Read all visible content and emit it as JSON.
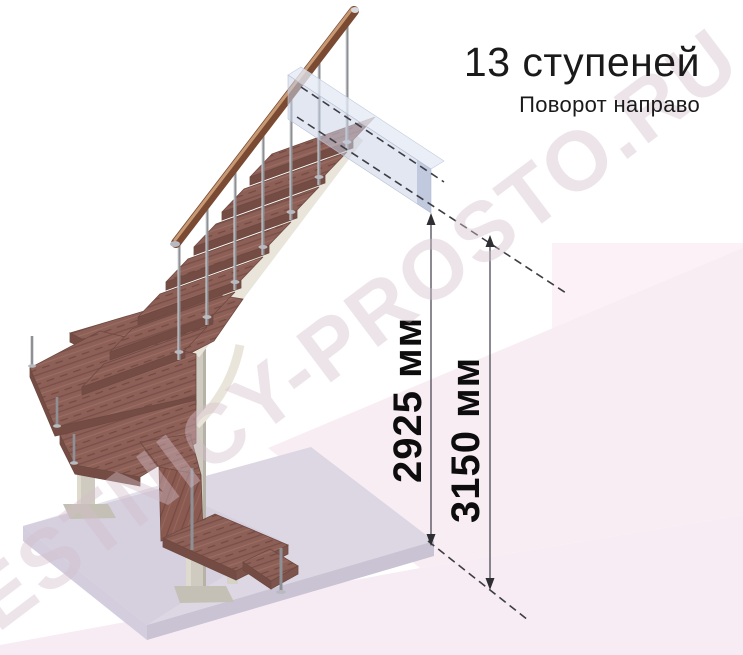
{
  "header": {
    "title": "13 ступеней",
    "subtitle": "Поворот направо"
  },
  "dimensions": {
    "inner": {
      "label": "2925 мм"
    },
    "outer": {
      "label": "3150 мм"
    }
  },
  "watermark": {
    "text": "LESTNICY-PROSTO.RU"
  },
  "scene": {
    "steps_total": "13",
    "turn_direction": "направо",
    "colors": {
      "wood": "#8d6057",
      "wood_edge": "#6e4a42",
      "handrail": "#7a4a33",
      "metal_frame": "#cfcbc0",
      "chrome": "#8f9096",
      "floor": "#dcd7e3",
      "landing_slab": "#cbd4e8",
      "background_pink": "#f9edf4",
      "dimension_line": "#4b4b55",
      "text": "#1a1a1a"
    }
  }
}
